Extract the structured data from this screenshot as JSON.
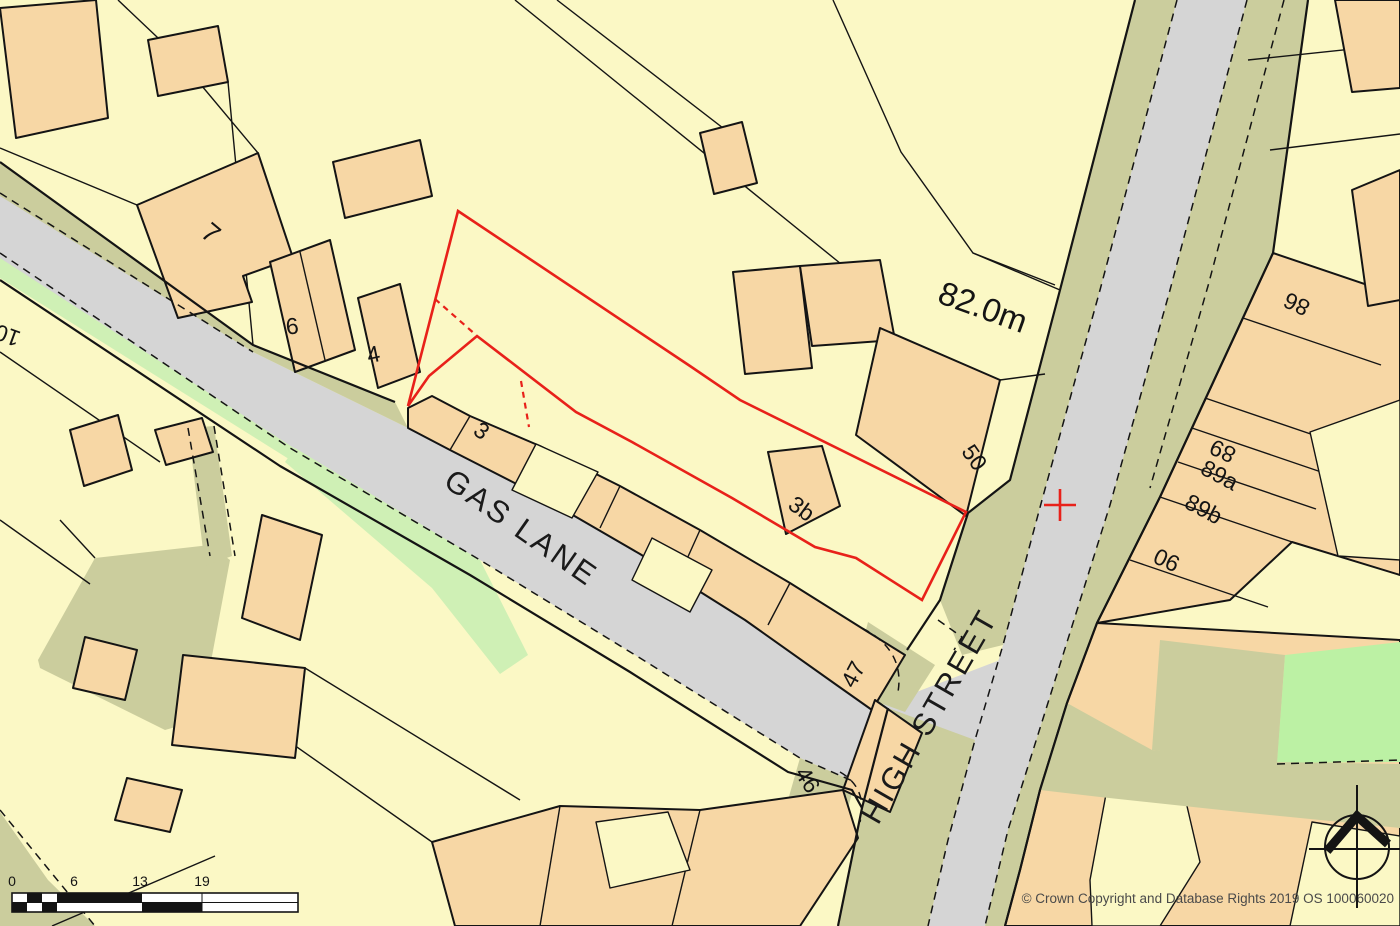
{
  "map": {
    "colors": {
      "background": "#FBF8C5",
      "building_fill": "#F7D7A5",
      "road_fill": "#D5D5D5",
      "verge_fill": "#CBCD9D",
      "green_strip": "#CFF0B5",
      "grass_bright": "#BCF1A4",
      "boundary_red": "#E8211A",
      "line_black": "#141414",
      "copyright_gray": "#4A4A4A"
    },
    "labels": [
      {
        "id": "street-gas-lane",
        "text": "GAS LANE"
      },
      {
        "id": "street-high-street",
        "text": "HIGH STREET"
      },
      {
        "id": "elevation",
        "text": "82.0m"
      },
      {
        "id": "house-7",
        "text": "7"
      },
      {
        "id": "house-6",
        "text": "6"
      },
      {
        "id": "house-4",
        "text": "4"
      },
      {
        "id": "house-10",
        "text": "10"
      },
      {
        "id": "house-3",
        "text": "3"
      },
      {
        "id": "house-3b",
        "text": "3b"
      },
      {
        "id": "house-50",
        "text": "50"
      },
      {
        "id": "house-47",
        "text": "47"
      },
      {
        "id": "house-46",
        "text": "46"
      },
      {
        "id": "house-86",
        "text": "86"
      },
      {
        "id": "house-89",
        "text": "89"
      },
      {
        "id": "house-89a",
        "text": "89a"
      },
      {
        "id": "house-89b",
        "text": "89b"
      },
      {
        "id": "house-90",
        "text": "90"
      },
      {
        "id": "copyright",
        "text": "© Crown Copyright and Database Rights 2019 OS 100060020"
      }
    ],
    "scale_bar": {
      "tick_labels": [
        "0",
        "6",
        "13",
        "19"
      ]
    },
    "markers": {
      "site_boundary": "red-outline",
      "location_cross": "red-plus-marker",
      "compass": "north-arrow"
    }
  }
}
